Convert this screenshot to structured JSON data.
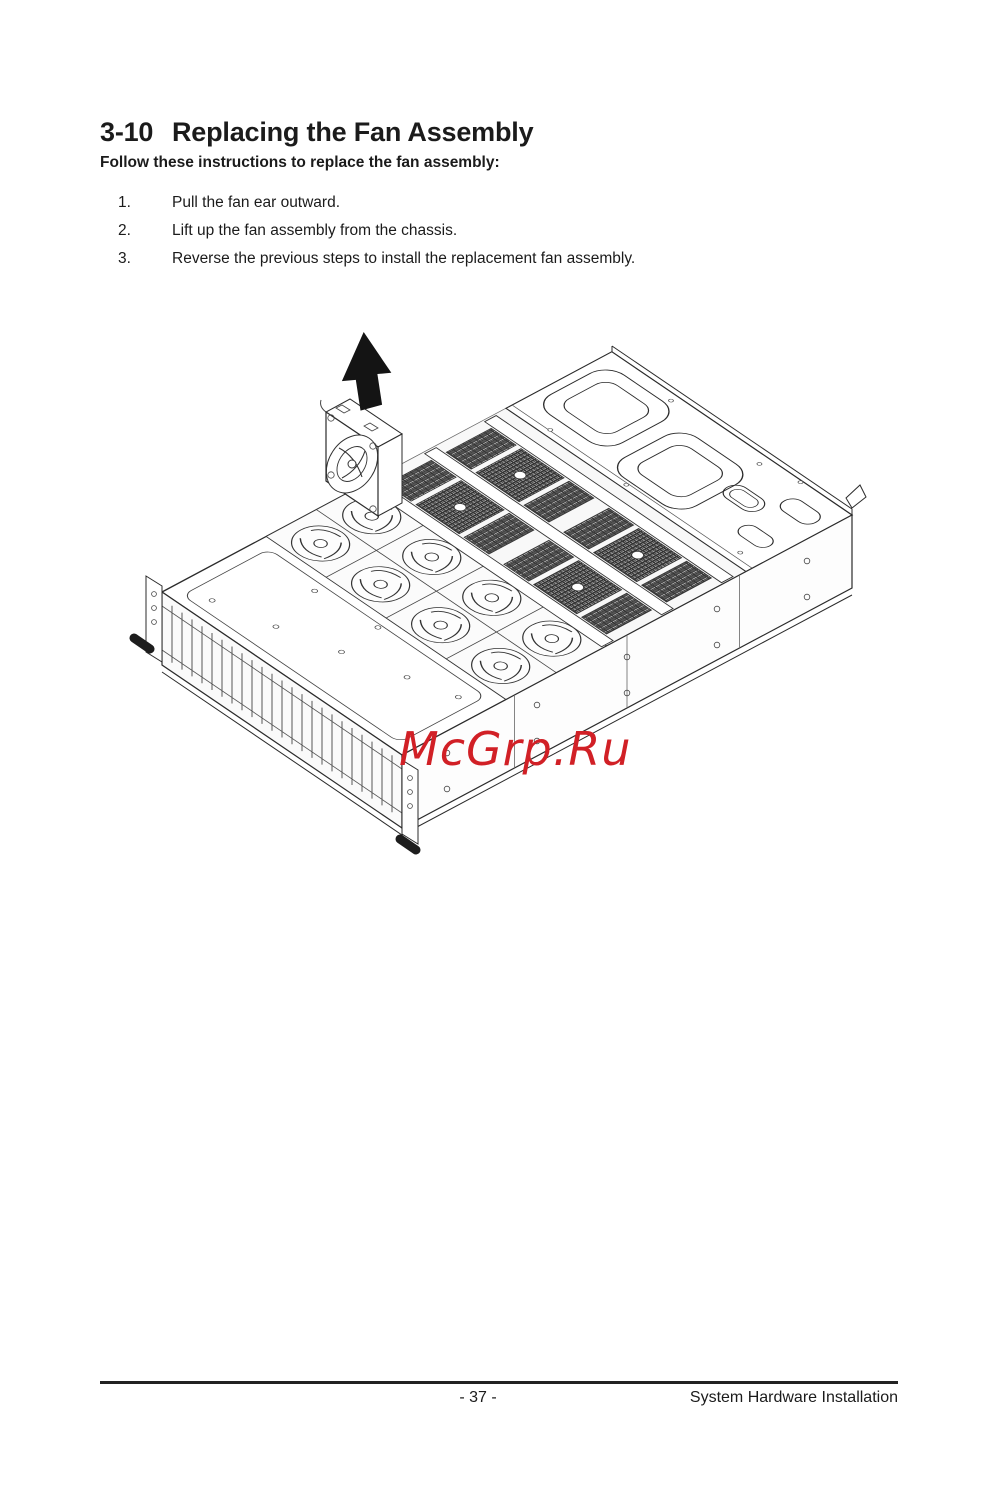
{
  "page": {
    "section_number": "3-10",
    "section_title": "Replacing the Fan Assembly",
    "intro": "Follow these instructions to replace the fan assembly:",
    "steps": [
      {
        "num": "1.",
        "text": "Pull the fan ear outward."
      },
      {
        "num": "2.",
        "text": "Lift up the fan assembly from the chassis."
      },
      {
        "num": "3.",
        "text": "Reverse the previous steps to install the replacement fan assembly."
      }
    ],
    "figure": {
      "description": "Isometric line drawing of a 2U server chassis with a fan assembly removed and an arrow pointing up",
      "watermark": "McGrp.Ru",
      "watermark_color": "#d12026"
    },
    "footer": {
      "page_number": "- 37 -",
      "title": "System Hardware Installation"
    }
  }
}
